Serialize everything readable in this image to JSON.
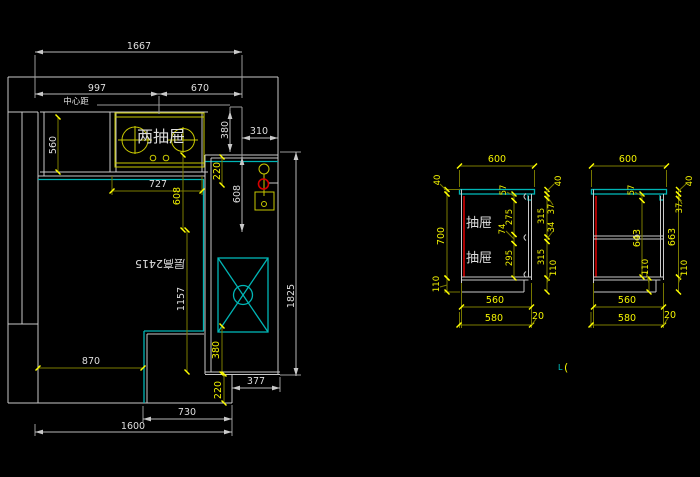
{
  "plan": {
    "center_label": "中心距",
    "cooktop_label": "两抽屉",
    "ceiling_label": "层高2415",
    "dims": {
      "overall_width": "1667",
      "left_to_cooktop_center": "997",
      "cooktop_center_to_wall": "670",
      "counter_depth": "560",
      "top_offset": "380",
      "right_offset": "310",
      "gap_top": "220",
      "cooktop_run": "727",
      "center_drop_left": "608",
      "center_drop_right": "608",
      "right_counter_length": "1825",
      "center_drop_lower": "1157",
      "sink_to_front": "380",
      "bottom_left_run": "870",
      "bottom_right_run": "377",
      "gap_bottom": "220",
      "bottom_mid_run": "730",
      "bottom_overall": "1600"
    }
  },
  "cab1": {
    "drawer_label_1": "抽屉",
    "drawer_label_2": "抽屉",
    "dims": {
      "width_top": "600",
      "counter_thickness_left": "40",
      "body_height": "700",
      "toe_kick_left": "110",
      "top_rail": "57",
      "drawer_top": "275",
      "rail_mid": "74",
      "drawer_bottom": "295",
      "counter_thickness_right": "40",
      "gap_top": "37",
      "front_top": "315",
      "gap_mid": "34",
      "front_bottom": "315",
      "toe_kick_right": "110",
      "depth_body": "560",
      "depth_counter": "580",
      "overhang": "20"
    }
  },
  "cab2": {
    "dims": {
      "width_top": "600",
      "top_rail": "57",
      "door_height": "643",
      "body_height": "663",
      "counter_thickness": "40",
      "gap_top": "37",
      "toe_kick_inner": "110",
      "toe_kick_right": "110",
      "depth_body": "560",
      "depth_counter": "580",
      "overhang": "20"
    }
  },
  "marker": {
    "l": "L",
    "paren": "("
  }
}
